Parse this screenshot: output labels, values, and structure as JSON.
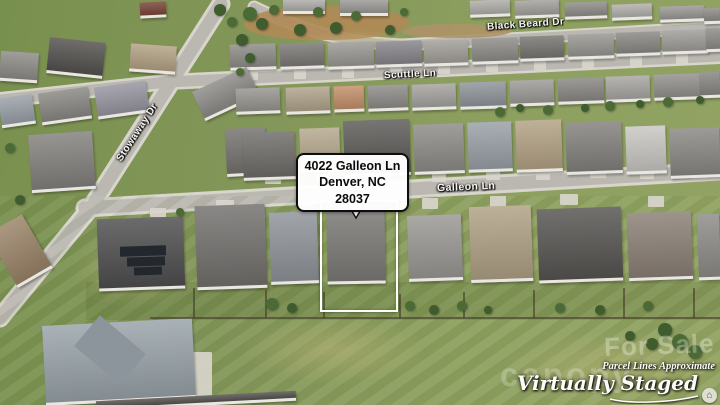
{
  "annotation": {
    "line1": "4022 Galleon Ln",
    "line2": "Denver, NC 28037"
  },
  "streets": {
    "black_beard": "Black Beard Dr",
    "scuttle": "Scuttle Ln",
    "galleon": "Galleon Ln",
    "stowaway": "Stowaway Dr"
  },
  "watermarks": {
    "for_sale": "For Sale",
    "brand": "canopy",
    "parcel": "Parcel Lines Approximate",
    "staged": "Virtually Staged",
    "emblem_glyph": "⌂"
  },
  "colors": {
    "annotation_bg": "#ffffff",
    "annotation_border": "#0d0d0d",
    "outline": "#fdfdfb",
    "road": "#bbb8b1",
    "sidewalk": "#d8d5cc"
  },
  "scene": {
    "houses": [
      [
        140,
        2,
        26,
        16,
        "#7a4438",
        -3
      ],
      [
        0,
        52,
        38,
        30,
        "#8e8c88",
        4
      ],
      [
        48,
        40,
        56,
        36,
        "#54524f",
        6
      ],
      [
        130,
        45,
        46,
        28,
        "#b3a284",
        4
      ],
      [
        283,
        0,
        42,
        14,
        "#aeaca8",
        0
      ],
      [
        340,
        0,
        48,
        16,
        "#9b9995",
        0
      ],
      [
        470,
        0,
        40,
        17,
        "#b0aeaa",
        -2
      ],
      [
        515,
        0,
        44,
        18,
        "#a3a19d",
        -2
      ],
      [
        565,
        2,
        42,
        17,
        "#8f8d89",
        -2
      ],
      [
        612,
        4,
        40,
        16,
        "#b2b0ac",
        -2
      ],
      [
        660,
        6,
        44,
        16,
        "#9a9894",
        -2
      ],
      [
        704,
        8,
        16,
        16,
        "#8e8c88",
        -2
      ],
      [
        230,
        44,
        46,
        26,
        "#8e8c88",
        -2
      ],
      [
        280,
        43,
        44,
        26,
        "#7b7976",
        -2
      ],
      [
        328,
        42,
        46,
        27,
        "#9a9894",
        -2
      ],
      [
        376,
        41,
        46,
        26,
        "#87858b",
        -2
      ],
      [
        424,
        40,
        44,
        26,
        "#a29f9a",
        -2
      ],
      [
        472,
        38,
        46,
        26,
        "#8e8c88",
        -2
      ],
      [
        520,
        36,
        44,
        25,
        "#777571",
        -2
      ],
      [
        568,
        34,
        46,
        25,
        "#989691",
        -2
      ],
      [
        616,
        32,
        44,
        24,
        "#8a8884",
        -2
      ],
      [
        662,
        30,
        46,
        24,
        "#9f9d99",
        -2
      ],
      [
        706,
        28,
        14,
        24,
        "#8e8c88",
        -2
      ],
      [
        0,
        96,
        34,
        30,
        "#99a0a6",
        -8
      ],
      [
        40,
        90,
        50,
        32,
        "#8a8884",
        -8
      ],
      [
        96,
        84,
        52,
        32,
        "#9795a0",
        -8
      ],
      [
        196,
        78,
        60,
        32,
        "#8e8c88",
        -25
      ],
      [
        236,
        88,
        44,
        26,
        "#97958f",
        -2
      ],
      [
        286,
        87,
        44,
        27,
        "#b0a38b",
        -2
      ],
      [
        334,
        86,
        30,
        26,
        "#c2906a",
        -2
      ],
      [
        368,
        85,
        40,
        26,
        "#8e8c88",
        -2
      ],
      [
        412,
        84,
        44,
        26,
        "#a5a39f",
        -2
      ],
      [
        460,
        82,
        46,
        27,
        "#90959b",
        -2
      ],
      [
        510,
        80,
        44,
        26,
        "#9d9b97",
        -2
      ],
      [
        558,
        78,
        46,
        26,
        "#8a8884",
        -2
      ],
      [
        606,
        76,
        44,
        26,
        "#a8a6a2",
        -2
      ],
      [
        654,
        74,
        46,
        26,
        "#93918d",
        -2
      ],
      [
        700,
        72,
        20,
        26,
        "#888682",
        -2
      ],
      [
        30,
        133,
        64,
        58,
        "#83817d",
        -4
      ],
      [
        226,
        128,
        40,
        48,
        "#75736f",
        -3
      ],
      [
        243,
        132,
        52,
        48,
        "#6f6d69",
        -2
      ],
      [
        300,
        128,
        40,
        44,
        "#b5a88e",
        -2
      ],
      [
        344,
        120,
        66,
        56,
        "#5d5b58",
        -2
      ],
      [
        414,
        124,
        50,
        50,
        "#8e8c88",
        -2
      ],
      [
        468,
        122,
        44,
        50,
        "#99a0a6",
        -2
      ],
      [
        516,
        120,
        46,
        52,
        "#b3a284",
        -2
      ],
      [
        566,
        122,
        56,
        52,
        "#83817d",
        -2
      ],
      [
        626,
        126,
        40,
        48,
        "#c9c7c2",
        -2
      ],
      [
        670,
        128,
        50,
        50,
        "#8a8884",
        -2
      ],
      [
        0,
        220,
        40,
        62,
        "#9b8468",
        -30
      ],
      [
        98,
        218,
        86,
        72,
        "#4f4f4f",
        -2
      ],
      [
        196,
        205,
        70,
        84,
        "#73716e",
        -2
      ],
      [
        270,
        212,
        48,
        72,
        "#8f9499",
        -2
      ],
      [
        327,
        204,
        58,
        80,
        "#7d7b78",
        -1
      ],
      [
        408,
        215,
        54,
        66,
        "#9a9894",
        -2
      ],
      [
        470,
        206,
        62,
        76,
        "#b0a185",
        -2
      ],
      [
        538,
        208,
        84,
        74,
        "#575552",
        -2
      ],
      [
        628,
        212,
        64,
        68,
        "#8b8076",
        -2
      ],
      [
        698,
        214,
        22,
        66,
        "#8e8c88",
        -2
      ],
      [
        44,
        322,
        150,
        80,
        "#99a3a9",
        -3
      ],
      [
        96,
        396,
        200,
        10,
        "#55534f",
        -3
      ]
    ],
    "decor": [
      [
        120,
        246,
        46,
        10,
        "#23272e",
        -2
      ],
      [
        127,
        257,
        38,
        9,
        "#23272e",
        -2
      ],
      [
        134,
        267,
        28,
        8,
        "#23272e",
        -2
      ],
      [
        80,
        330,
        60,
        40,
        "#8b959b",
        40
      ]
    ],
    "driveways": [
      [
        246,
        68,
        12,
        12
      ],
      [
        294,
        67,
        12,
        12
      ],
      [
        342,
        66,
        12,
        12
      ],
      [
        390,
        64,
        12,
        12
      ],
      [
        438,
        62,
        12,
        12
      ],
      [
        486,
        60,
        12,
        12
      ],
      [
        534,
        58,
        12,
        12
      ],
      [
        582,
        56,
        12,
        12
      ],
      [
        630,
        54,
        12,
        12
      ],
      [
        676,
        52,
        12,
        12
      ],
      [
        265,
        172,
        16,
        12
      ],
      [
        316,
        168,
        14,
        14
      ],
      [
        432,
        168,
        14,
        14
      ],
      [
        486,
        166,
        14,
        14
      ],
      [
        536,
        166,
        14,
        14
      ],
      [
        590,
        166,
        16,
        12
      ],
      [
        640,
        168,
        14,
        11
      ],
      [
        692,
        170,
        14,
        9
      ],
      [
        350,
        196,
        20,
        9
      ],
      [
        422,
        198,
        16,
        11
      ],
      [
        490,
        196,
        16,
        11
      ],
      [
        560,
        194,
        18,
        11
      ],
      [
        648,
        196,
        16,
        11
      ],
      [
        216,
        200,
        18,
        11
      ],
      [
        150,
        208,
        16,
        9
      ],
      [
        150,
        352,
        62,
        48
      ]
    ],
    "trees": [
      [
        250,
        14,
        7
      ],
      [
        262,
        24,
        6
      ],
      [
        274,
        10,
        5
      ],
      [
        300,
        30,
        6
      ],
      [
        318,
        12,
        5
      ],
      [
        336,
        28,
        6
      ],
      [
        356,
        16,
        5
      ],
      [
        390,
        30,
        5
      ],
      [
        404,
        12,
        4
      ],
      [
        242,
        40,
        6
      ],
      [
        500,
        112,
        5
      ],
      [
        520,
        108,
        4
      ],
      [
        548,
        110,
        5
      ],
      [
        585,
        108,
        4
      ],
      [
        610,
        106,
        5
      ],
      [
        640,
        104,
        4
      ],
      [
        668,
        102,
        5
      ],
      [
        700,
        100,
        4
      ],
      [
        272,
        304,
        6
      ],
      [
        292,
        308,
        5
      ],
      [
        410,
        306,
        5
      ],
      [
        434,
        310,
        5
      ],
      [
        462,
        306,
        5
      ],
      [
        488,
        310,
        4
      ],
      [
        560,
        308,
        5
      ],
      [
        600,
        310,
        5
      ],
      [
        648,
        306,
        5
      ],
      [
        665,
        330,
        7
      ],
      [
        680,
        342,
        8
      ],
      [
        652,
        344,
        6
      ],
      [
        695,
        352,
        7
      ],
      [
        630,
        336,
        5
      ],
      [
        10,
        148,
        5
      ],
      [
        20,
        200,
        5
      ],
      [
        180,
        212,
        4
      ],
      [
        220,
        10,
        6
      ],
      [
        232,
        22,
        5
      ],
      [
        250,
        58,
        5
      ],
      [
        240,
        72,
        4
      ]
    ],
    "fences": [
      [
        193,
        288,
        2,
        30
      ],
      [
        265,
        290,
        2,
        28
      ],
      [
        323,
        292,
        2,
        26
      ],
      [
        399,
        294,
        2,
        24
      ],
      [
        463,
        292,
        2,
        26
      ],
      [
        533,
        290,
        2,
        28
      ],
      [
        623,
        288,
        2,
        30
      ],
      [
        693,
        288,
        2,
        30
      ],
      [
        150,
        317,
        570,
        2
      ]
    ],
    "patches": [
      [
        70,
        225,
        130,
        85
      ],
      [
        240,
        315,
        190,
        70
      ],
      [
        500,
        330,
        220,
        80
      ],
      [
        300,
        30,
        120,
        30
      ]
    ],
    "dirt": [
      [
        244,
        6,
        165,
        34,
        "#b08a56"
      ],
      [
        402,
        24,
        110,
        14,
        "#ad9468"
      ]
    ]
  }
}
